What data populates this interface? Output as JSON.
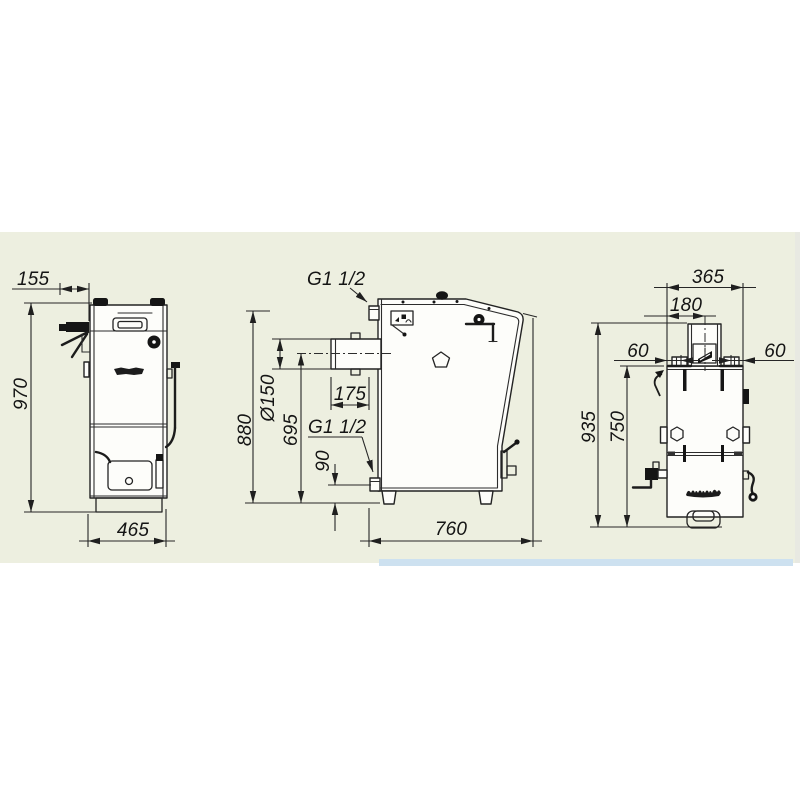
{
  "page": {
    "background": "#ffffff"
  },
  "drawing_panel": {
    "background": "#edefe0",
    "accent_strip_color": "#cde1f0",
    "edge_strip_color": "#e8e9e2",
    "line_color": "#2c2c2c"
  },
  "views": {
    "front": {
      "dim_door_offset": "155",
      "dim_height": "970",
      "dim_width": "465"
    },
    "side": {
      "supply_fitting_label": "G1 1/2",
      "return_fitting_label": "G1 1/2",
      "flue_diameter": "Ø150",
      "flue_stub_length": "175",
      "dim_height_to_supply": "880",
      "dim_flue_axis_height": "695",
      "dim_return_axis_height": "90",
      "dim_depth": "760"
    },
    "rear": {
      "dim_width": "365",
      "dim_flue_axis_offset": "180",
      "dim_left_fitting_offset": "60",
      "dim_right_fitting_offset": "60",
      "dim_overall_height": "935",
      "dim_jacket_height": "750"
    }
  }
}
